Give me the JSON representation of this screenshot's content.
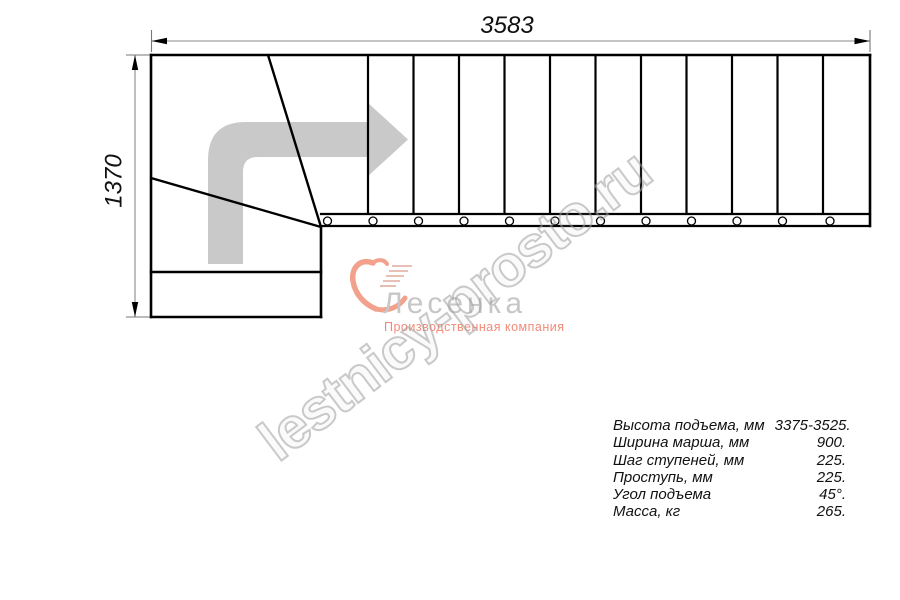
{
  "drawing": {
    "title": "staircase-plan-view",
    "top_dimension": "3583",
    "left_dimension": "1370"
  },
  "watermark": {
    "text": "lestnicy-prosto.ru"
  },
  "logo": {
    "name": "Лесенка",
    "tagline": "Производственная компания",
    "symbol_icon": "stair-swoosh-icon"
  },
  "icons": {
    "direction_arrow": "turn-right-arrow"
  },
  "specs": {
    "rows": [
      {
        "label": "Высота подъема, мм",
        "value": "3375-3525."
      },
      {
        "label": "Ширина марша, мм",
        "value": "900."
      },
      {
        "label": "Шаг ступеней, мм",
        "value": "225."
      },
      {
        "label": "Проступь, мм",
        "value": "225."
      },
      {
        "label": "Угол подъема",
        "value": "45°."
      },
      {
        "label": "Масса, кг",
        "value": "265."
      }
    ]
  },
  "colors": {
    "line_black": "#000000",
    "dim_gray": "#777777",
    "arrow_gray": "#c9c9c9",
    "watermark_gray": "#9e9e9e",
    "logo_orange": "#f2a18c",
    "tagline_coral": "#f18a77",
    "logo_text_gray": "#c7c7c7"
  }
}
